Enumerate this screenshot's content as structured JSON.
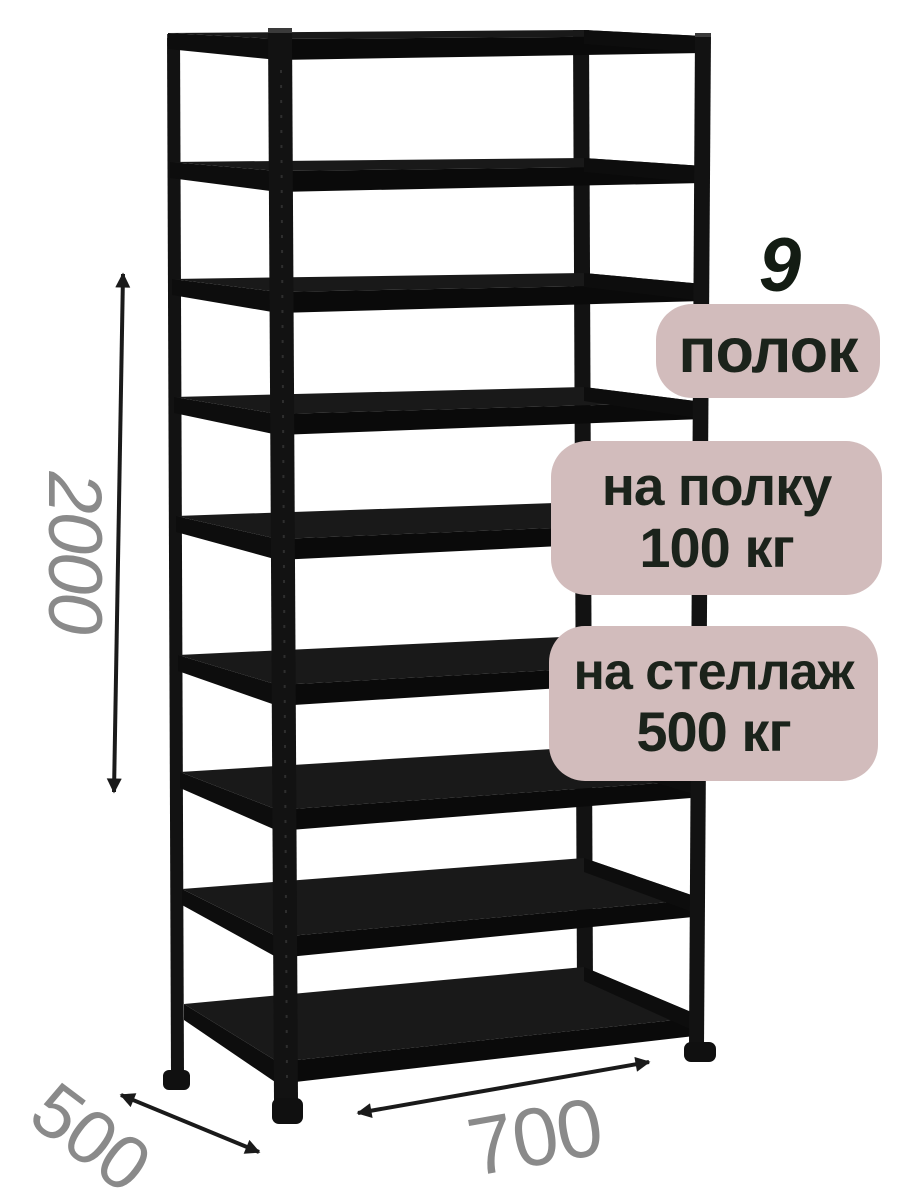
{
  "badges": {
    "shelf_count": {
      "number": "9",
      "label": "полок"
    },
    "per_shelf": {
      "line1": "на полку",
      "line2": "100 кг"
    },
    "per_rack": {
      "line1": "на стеллаж",
      "line2": "500 кг"
    }
  },
  "dimensions": {
    "height": "2000",
    "width": "700",
    "depth": "500"
  },
  "rack": {
    "shelf_count": 9,
    "material_color_name": "black"
  },
  "colors": {
    "background": "#ffffff",
    "badge_bg": "#d2bcbc",
    "badge_text": "#1b231b",
    "dimension_text": "#8a8a8a",
    "arrow": "#1a1a1a",
    "rack_surface": "#191919",
    "rack_edge": "#0a0a0a",
    "rack_post": "#121212"
  }
}
